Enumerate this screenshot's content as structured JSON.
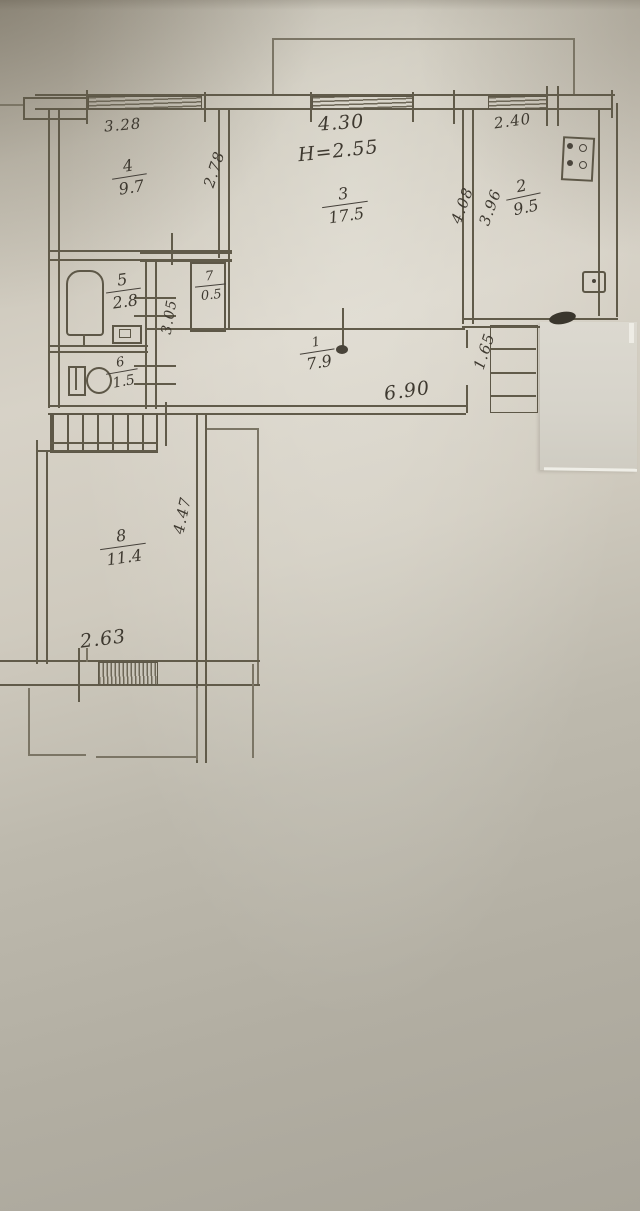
{
  "document": {
    "kind": "apartment floor plan (scanned hand-drawn BTI sheet)",
    "ceiling_height_label": "H=2.55"
  },
  "rooms": {
    "hall": {
      "number": "1",
      "area": "7.9"
    },
    "kitchen": {
      "number": "2",
      "area": "9.5"
    },
    "living": {
      "number": "3",
      "area": "17.5"
    },
    "bedroom1": {
      "number": "4",
      "area": "9.7"
    },
    "bath": {
      "number": "5",
      "area": "2.8"
    },
    "wc": {
      "number": "6",
      "area": "1.5"
    },
    "closet": {
      "number": "7",
      "area": "0.5"
    },
    "bedroom2": {
      "number": "8",
      "area": "11.4"
    }
  },
  "dimensions": {
    "bedroom1_width": "3.28",
    "bedroom1_depth": "2.78",
    "living_width": "4.30",
    "living_depth": "4.08",
    "kitchen_width": "2.40",
    "kitchen_depth": "3.96",
    "hall_vertical": "3.05",
    "hall_length": "6.90",
    "entry_width": "1.65",
    "bedroom2_width": "2.63",
    "bedroom2_depth": "4.47"
  },
  "colors": {
    "paper_light": "#d7d2c7",
    "paper_dark": "#a9a59a",
    "ink": "#5d5747",
    "handwriting": "#3e3930",
    "patch": "#d8d5cc"
  }
}
